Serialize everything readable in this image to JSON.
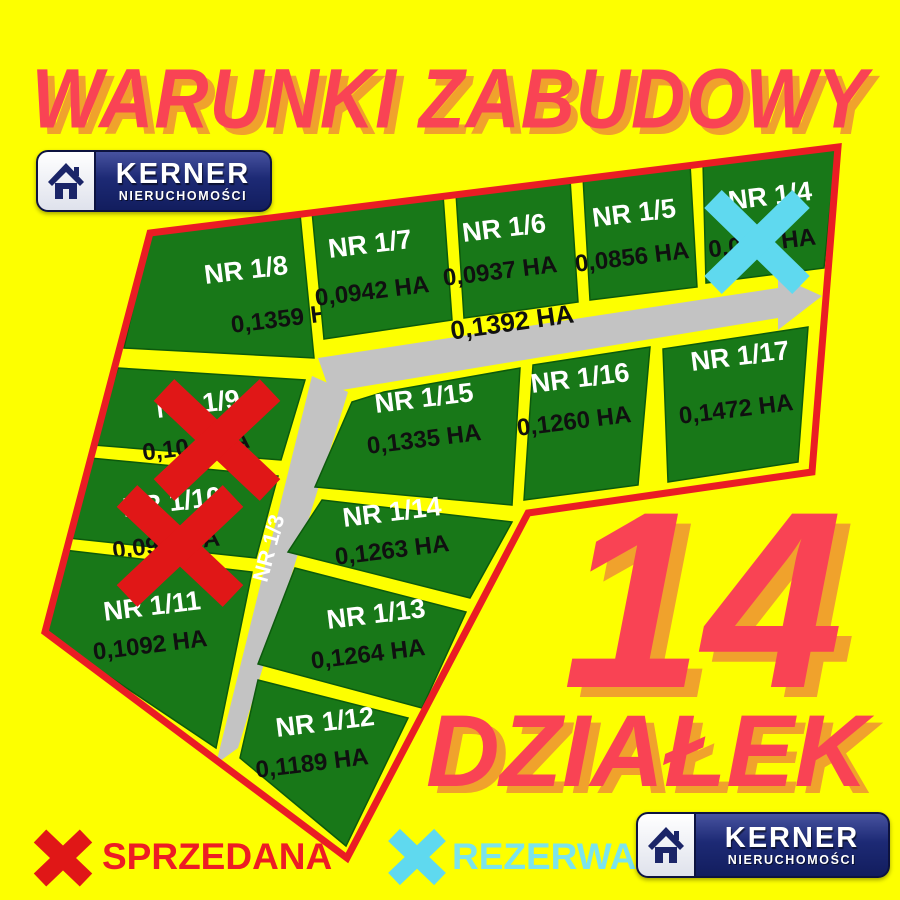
{
  "title": "WARUNKI ZABUDOWY",
  "brand": {
    "name": "KERNER",
    "subtitle": "NIERUCHOMOŚCI"
  },
  "headline": {
    "count": "14",
    "label": "DZIAŁEK"
  },
  "legend": {
    "sold": {
      "label": "SPRZEDANA",
      "color": "#ed1c24"
    },
    "reserved": {
      "label": "REZERWACJA",
      "color": "#7be4ec"
    }
  },
  "map": {
    "road": {
      "name": "NR 1/3",
      "area": "0,1392 HA"
    },
    "plots": [
      {
        "id": "nr-1-8",
        "name": "NR 1/8",
        "area": "0,1359 HA"
      },
      {
        "id": "nr-1-7",
        "name": "NR 1/7",
        "area": "0,0942 HA"
      },
      {
        "id": "nr-1-6",
        "name": "NR 1/6",
        "area": "0,0937 HA"
      },
      {
        "id": "nr-1-5",
        "name": "NR 1/5",
        "area": "0,0856 HA"
      },
      {
        "id": "nr-1-4",
        "name": "NR 1/4",
        "area": "0,09    HA",
        "status": "rezerwacja"
      },
      {
        "id": "nr-1-9",
        "name": "NR 1/9",
        "area": "0,10    HA",
        "status": "sprzedana"
      },
      {
        "id": "nr-1-10",
        "name": "NR 1/10",
        "area": "0,09    HA",
        "status": "sprzedana"
      },
      {
        "id": "nr-1-11",
        "name": "NR 1/11",
        "area": "0,1092 HA"
      },
      {
        "id": "nr-1-15",
        "name": "NR 1/15",
        "area": "0,1335 HA"
      },
      {
        "id": "nr-1-16",
        "name": "NR 1/16",
        "area": "0,1260 HA"
      },
      {
        "id": "nr-1-17",
        "name": "NR 1/17",
        "area": "0,1472 HA"
      },
      {
        "id": "nr-1-14",
        "name": "NR 1/14",
        "area": "0,1263 HA"
      },
      {
        "id": "nr-1-13",
        "name": "NR 1/13",
        "area": "0,1264 HA"
      },
      {
        "id": "nr-1-12",
        "name": "NR 1/12",
        "area": "0,1189 HA"
      }
    ]
  },
  "colors": {
    "background": "#fdff00",
    "plot_green": "#187818",
    "road_gray": "#c3c3c3",
    "boundary_red": "#ea1c24",
    "accent_red": "#f94354",
    "shadow_orange": "#f0a22c",
    "x_sold_red": "#e01717",
    "x_reserved_cyan": "#5fd9ef",
    "brand_navy": "#1d2a75"
  }
}
